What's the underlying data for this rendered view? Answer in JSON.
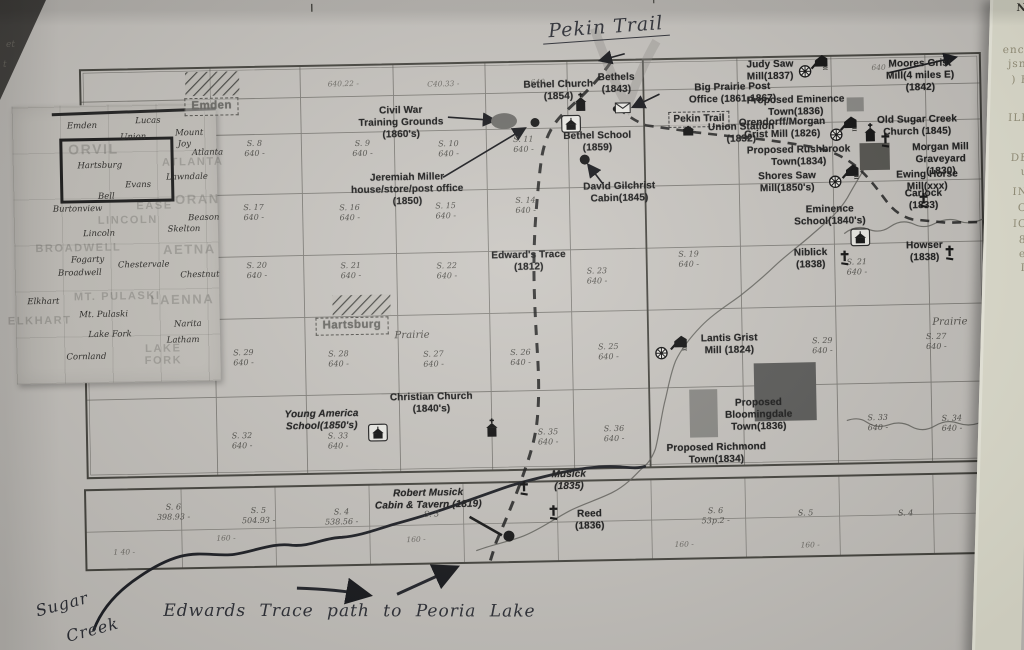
{
  "page": {
    "handwritten_title": "Pekin Trail",
    "handwritten_sugar_line1": "Sugar",
    "handwritten_sugar_line2": "Creek",
    "handwritten_note": "Edwards Trace path to Peoria Lake"
  },
  "right_page_fragments": [
    {
      "t": "NI",
      "y": 2,
      "dark": true
    },
    {
      "t": "ence",
      "y": 44
    },
    {
      "t": "jsnf",
      "y": 58
    },
    {
      "t": ") H",
      "y": 74
    },
    {
      "t": "ILE",
      "y": 112
    },
    {
      "t": "DE",
      "y": 152
    },
    {
      "t": "u",
      "y": 166
    },
    {
      "t": "IN",
      "y": 186
    },
    {
      "t": "O",
      "y": 202
    },
    {
      "t": "IC",
      "y": 218
    },
    {
      "t": "8",
      "y": 234
    },
    {
      "t": "e",
      "y": 248
    },
    {
      "t": "I",
      "y": 262
    }
  ],
  "margin_marks": [
    {
      "t": "et",
      "x": 6,
      "y": 40
    },
    {
      "t": "t",
      "x": 3,
      "y": 60
    }
  ],
  "inset": {
    "townships": [
      {
        "t": "ORVIL",
        "x": 97,
        "y": 141,
        "s": 14
      },
      {
        "t": "ATLANTA",
        "x": 196,
        "y": 156
      },
      {
        "t": "ORAN",
        "x": 200,
        "y": 193,
        "s": 13
      },
      {
        "t": "EASE",
        "x": 157,
        "y": 199
      },
      {
        "t": "LINCOLN",
        "x": 130,
        "y": 213
      },
      {
        "t": "AETNA",
        "x": 191,
        "y": 243,
        "s": 13
      },
      {
        "t": "MT. PULASKI",
        "x": 118,
        "y": 289
      },
      {
        "t": "LAENNA",
        "x": 183,
        "y": 293,
        "s": 13
      },
      {
        "t": "ELKHART",
        "x": 40,
        "y": 312
      },
      {
        "t": "BROADWELL",
        "x": 80,
        "y": 240
      },
      {
        "t": "LAKE",
        "x": 163,
        "y": 342
      },
      {
        "t": "FORK",
        "x": 163,
        "y": 354
      }
    ],
    "towns": [
      {
        "t": "Emden",
        "x": 86,
        "y": 118
      },
      {
        "t": "Lucas",
        "x": 152,
        "y": 114
      },
      {
        "t": "Union",
        "x": 137,
        "y": 130
      },
      {
        "t": "Mount",
        "x": 193,
        "y": 127
      },
      {
        "t": "Joy",
        "x": 188,
        "y": 138
      },
      {
        "t": "Atlanta",
        "x": 211,
        "y": 147
      },
      {
        "t": "Hartsburg",
        "x": 103,
        "y": 158
      },
      {
        "t": "Lawndale",
        "x": 190,
        "y": 171
      },
      {
        "t": "Evans",
        "x": 141,
        "y": 178
      },
      {
        "t": "Bell",
        "x": 109,
        "y": 189
      },
      {
        "t": "Burtonview",
        "x": 80,
        "y": 201
      },
      {
        "t": "Lincoln",
        "x": 101,
        "y": 226
      },
      {
        "t": "Beason",
        "x": 206,
        "y": 212
      },
      {
        "t": "Skelton",
        "x": 186,
        "y": 223
      },
      {
        "t": "Fogarty",
        "x": 89,
        "y": 252
      },
      {
        "t": "Broadwell",
        "x": 81,
        "y": 265
      },
      {
        "t": "Chestervale",
        "x": 145,
        "y": 258
      },
      {
        "t": "Chestnut",
        "x": 201,
        "y": 269
      },
      {
        "t": "Elkhart",
        "x": 44,
        "y": 293
      },
      {
        "t": "Mt. Pulaski",
        "x": 104,
        "y": 307
      },
      {
        "t": "Narita",
        "x": 188,
        "y": 318
      },
      {
        "t": "Lake Fork",
        "x": 110,
        "y": 327
      },
      {
        "t": "Latham",
        "x": 183,
        "y": 334
      },
      {
        "t": "Cornland",
        "x": 86,
        "y": 349
      }
    ]
  },
  "map": {
    "site_labels": [
      {
        "id": "label-bethel-church",
        "text": "Bethel Church\n(1854)",
        "x": 563,
        "y": 80
      },
      {
        "id": "label-bethels",
        "text": "Bethels\n(1843)",
        "x": 621,
        "y": 74
      },
      {
        "id": "label-big-prairie-post-office",
        "text": "Big Prairie Post\nOffice (1861-1867)",
        "x": 737,
        "y": 86
      },
      {
        "id": "label-judy-saw-mill",
        "text": "Judy  Saw\nMill(1837)",
        "x": 775,
        "y": 64
      },
      {
        "id": "label-moores-grist-mill",
        "text": "Moores Grist\nMill(4 miles E)\n(1842)",
        "x": 925,
        "y": 66
      },
      {
        "id": "label-proposed-eminence-town",
        "text": "Proposed Eminence\nTown(1836)",
        "x": 800,
        "y": 100
      },
      {
        "id": "label-orendorff-morgan-grist-mill",
        "text": "Orendorff/Morgan\nGrist Mill (1826)",
        "x": 786,
        "y": 122
      },
      {
        "id": "label-old-sugar-creek-church",
        "text": "Old Sugar Creek\nChurch (1845)",
        "x": 921,
        "y": 122
      },
      {
        "id": "label-morgan-mill-graveyard",
        "text": "Morgan Mill\nGraveyard (1830)",
        "x": 944,
        "y": 150
      },
      {
        "id": "label-ewing-horse-mill",
        "text": "Ewing Horse\nMill(xxx)",
        "x": 930,
        "y": 177
      },
      {
        "id": "label-pekin-trail-box",
        "text": "Pekin Trail",
        "x": 703,
        "y": 115,
        "cls": "boxed"
      },
      {
        "id": "label-union-station",
        "text": "Union Station\n(1832)",
        "x": 745,
        "y": 126
      },
      {
        "id": "label-proposed-rushbrook-town",
        "text": "Proposed Rushbrook\nTown(1834)",
        "x": 802,
        "y": 150
      },
      {
        "id": "label-shores-saw-mill",
        "text": "Shores Saw\nMill(1850's)",
        "x": 790,
        "y": 176
      },
      {
        "id": "label-eminence-school",
        "text": "Eminence\nSchool(1840's)",
        "x": 832,
        "y": 210
      },
      {
        "id": "label-carlock",
        "text": "Carlock\n(1833)",
        "x": 926,
        "y": 196
      },
      {
        "id": "label-niblick",
        "text": "Niblick\n(1838)",
        "x": 812,
        "y": 253
      },
      {
        "id": "label-howser",
        "text": "Howser\n(1838)",
        "x": 926,
        "y": 248
      },
      {
        "id": "label-civil-war-training-grounds",
        "text": "Civil War\nTraining Grounds\n(1860's)",
        "x": 405,
        "y": 103
      },
      {
        "id": "label-jeremiah-miller",
        "text": "Jeremiah Miller\nhouse/store/post office\n(1850)",
        "x": 410,
        "y": 170
      },
      {
        "id": "label-bethel-school",
        "text": "Bethel School\n(1859)",
        "x": 601,
        "y": 132
      },
      {
        "id": "label-david-gilchrist-cabin",
        "text": "David Gilchrist\nCabin(1845)",
        "x": 622,
        "y": 183
      },
      {
        "id": "label-edwards-trace",
        "text": "Edward's Trace\n(1812)",
        "x": 530,
        "y": 250
      },
      {
        "id": "label-lantis-grist-mill",
        "text": "Lantis Grist\nMill (1824)",
        "x": 729,
        "y": 337
      },
      {
        "id": "label-proposed-bloomingdale-town",
        "text": "Proposed\nBloomingdale\nTown(1836)",
        "x": 757,
        "y": 402
      },
      {
        "id": "label-proposed-richmond-town",
        "text": "Proposed Richmond\nTown(1834)",
        "x": 714,
        "y": 446
      },
      {
        "id": "label-young-america-school",
        "text": "Young America\nSchool(1850's)",
        "x": 320,
        "y": 405,
        "cls": "ital"
      },
      {
        "id": "label-christian-church",
        "text": "Christian Church\n(1840's)",
        "x": 430,
        "y": 390
      },
      {
        "id": "label-robert-musick",
        "text": "Robert Musick\nCabin & Tavern (1819)",
        "x": 425,
        "y": 486,
        "cls": "ital"
      },
      {
        "id": "label-musick",
        "text": "Musick\n(1835)",
        "x": 566,
        "y": 470,
        "cls": "ital"
      },
      {
        "id": "label-reed",
        "text": "Reed\n(1836)",
        "x": 586,
        "y": 510
      },
      {
        "id": "label-town-emden",
        "text": "Emden",
        "x": 216,
        "y": 92,
        "cls": "town"
      },
      {
        "id": "label-town-hartsburg",
        "text": "Hartsburg",
        "x": 352,
        "y": 314,
        "cls": "town"
      },
      {
        "id": "label-prairie-west",
        "text": "Prairie",
        "x": 412,
        "y": 328,
        "cls": "script"
      },
      {
        "id": "label-prairie-east",
        "text": "Prairie",
        "x": 950,
        "y": 325,
        "cls": "script"
      }
    ],
    "sections": [
      {
        "t": "S. 8",
        "b": "640 -",
        "x": 258,
        "y": 134
      },
      {
        "t": "S. 9",
        "b": "640 -",
        "x": 366,
        "y": 136
      },
      {
        "t": "S. 10",
        "b": "640 -",
        "x": 452,
        "y": 138
      },
      {
        "t": "S. 11",
        "b": "640 -",
        "x": 527,
        "y": 135
      },
      {
        "t": "S. 17",
        "b": "640 -",
        "x": 256,
        "y": 198
      },
      {
        "t": "S. 16",
        "b": "640 -",
        "x": 352,
        "y": 200
      },
      {
        "t": "S. 15",
        "b": "640 -",
        "x": 448,
        "y": 200
      },
      {
        "t": "S. 14",
        "b": "640 -",
        "x": 528,
        "y": 196
      },
      {
        "t": "S. 20",
        "b": "640 -",
        "x": 258,
        "y": 256
      },
      {
        "t": "S. 21",
        "b": "640 -",
        "x": 352,
        "y": 258
      },
      {
        "t": "S. 22",
        "b": "640 -",
        "x": 448,
        "y": 260
      },
      {
        "t": "S. 23",
        "b": "640 -",
        "x": 598,
        "y": 268
      },
      {
        "t": "S. 29",
        "b": "640 -",
        "x": 243,
        "y": 343
      },
      {
        "t": "S. 28",
        "b": "640 -",
        "x": 338,
        "y": 346
      },
      {
        "t": "S. 27",
        "b": "640 -",
        "x": 433,
        "y": 348
      },
      {
        "t": "S. 26",
        "b": "640 -",
        "x": 520,
        "y": 348
      },
      {
        "t": "S. 25",
        "b": "640 -",
        "x": 608,
        "y": 344
      },
      {
        "t": "S. 32",
        "b": "640 -",
        "x": 240,
        "y": 426
      },
      {
        "t": "S. 33",
        "b": "640 -",
        "x": 336,
        "y": 428
      },
      {
        "t": "S. 35",
        "b": "640 -",
        "x": 546,
        "y": 428
      },
      {
        "t": "S. 36",
        "b": "640 -",
        "x": 612,
        "y": 426
      },
      {
        "t": "S. 19",
        "b": "640 -",
        "x": 690,
        "y": 253
      },
      {
        "t": "S. 21",
        "b": "640 -",
        "x": 858,
        "y": 264
      },
      {
        "t": "S. 29",
        "b": "640 -",
        "x": 822,
        "y": 342
      },
      {
        "t": "S. 27",
        "b": "640 -",
        "x": 936,
        "y": 340
      },
      {
        "t": "S. 33",
        "b": "640 -",
        "x": 876,
        "y": 420
      },
      {
        "t": "S. 34",
        "b": "640 -",
        "x": 950,
        "y": 422
      },
      {
        "t": "S. 6",
        "b": "398.93 -",
        "x": 170,
        "y": 496
      },
      {
        "t": "S. 5",
        "b": "504.93 -",
        "x": 255,
        "y": 501
      },
      {
        "t": "S. 4",
        "b": "538.56 -",
        "x": 338,
        "y": 504
      },
      {
        "t": "S. 3",
        "b": "",
        "x": 428,
        "y": 508
      },
      {
        "t": "S. 6",
        "b": "53p.2 -",
        "x": 712,
        "y": 510
      },
      {
        "t": "S. 5",
        "b": "",
        "x": 802,
        "y": 514
      },
      {
        "t": "S. 4",
        "b": "",
        "x": 902,
        "y": 516
      }
    ],
    "faint_marks": [
      {
        "t": "640.22 -",
        "x": 348,
        "y": 76
      },
      {
        "t": "C40.33 -",
        "x": 448,
        "y": 78
      },
      {
        "t": "640 -",
        "x": 545,
        "y": 78
      },
      {
        "t": "640 -",
        "x": 886,
        "y": 70
      },
      {
        "t": "160 -",
        "x": 222,
        "y": 528
      },
      {
        "t": "160 -",
        "x": 412,
        "y": 533
      },
      {
        "t": "160 -",
        "x": 680,
        "y": 543
      },
      {
        "t": "160 -",
        "x": 806,
        "y": 546
      },
      {
        "t": "1 40 -",
        "x": 120,
        "y": 540
      }
    ],
    "icons": [
      {
        "type": "church",
        "name": "bethel-church-icon",
        "x": 585,
        "y": 104
      },
      {
        "type": "church",
        "name": "old-sugar-creek-church-icon",
        "x": 874,
        "y": 140
      },
      {
        "type": "church",
        "name": "christian-church-icon",
        "x": 490,
        "y": 428
      },
      {
        "type": "school",
        "name": "bethel-school-icon",
        "x": 575,
        "y": 125
      },
      {
        "type": "school",
        "name": "eminence-school-icon",
        "x": 862,
        "y": 244
      },
      {
        "type": "school",
        "name": "young-america-school-icon",
        "x": 376,
        "y": 430
      },
      {
        "type": "mill",
        "name": "judy-saw-mill-icon",
        "x": 825,
        "y": 68
      },
      {
        "type": "mill",
        "name": "orendorff-mill-icon",
        "x": 853,
        "y": 130
      },
      {
        "type": "mill",
        "name": "shores-saw-mill-icon",
        "x": 854,
        "y": 178
      },
      {
        "type": "mill",
        "name": "lantis-mill-icon",
        "x": 679,
        "y": 346
      },
      {
        "type": "wheel",
        "name": "judy-wheel-icon",
        "x": 810,
        "y": 77
      },
      {
        "type": "wheel",
        "name": "orendorff-wheel-icon",
        "x": 840,
        "y": 141
      },
      {
        "type": "wheel",
        "name": "shores-wheel-icon",
        "x": 838,
        "y": 188
      },
      {
        "type": "wheel",
        "name": "lantis-wheel-icon",
        "x": 661,
        "y": 356
      },
      {
        "type": "cross",
        "name": "morgan-graveyard-cross-icon",
        "x": 889,
        "y": 147
      },
      {
        "type": "cross",
        "name": "carlock-cross-icon",
        "x": 926,
        "y": 208
      },
      {
        "type": "cross",
        "name": "niblick-cross-icon",
        "x": 846,
        "y": 264
      },
      {
        "type": "cross",
        "name": "howser-cross-icon",
        "x": 951,
        "y": 261
      },
      {
        "type": "cross",
        "name": "musick-cross-icon",
        "x": 521,
        "y": 488
      },
      {
        "type": "cross",
        "name": "reed-cross-icon",
        "x": 550,
        "y": 513
      },
      {
        "type": "envelope",
        "name": "bethel-post-office-icon",
        "x": 627,
        "y": 110
      },
      {
        "type": "station",
        "name": "union-station-icon",
        "x": 692,
        "y": 134
      }
    ]
  }
}
